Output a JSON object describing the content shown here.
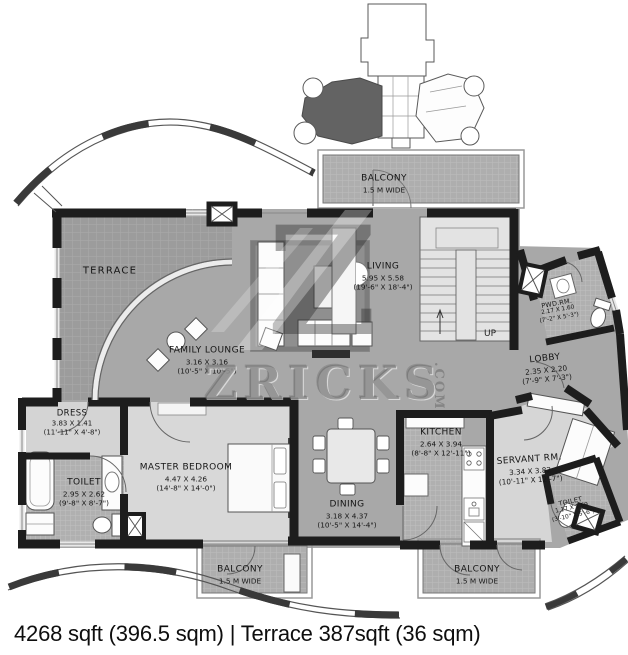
{
  "footer": {
    "caption": "4268 sqft (396.5 sqm) | Terrace 387sqft (36 sqm)"
  },
  "watermark": {
    "logo": "Z",
    "brand": "ZRICKS",
    "tld": ".COM"
  },
  "stairs": {
    "up": "UP"
  },
  "rooms": {
    "terrace": {
      "name": "TERRACE"
    },
    "balcony_top": {
      "name": "BALCONY",
      "dim_m": "1.5 M WIDE"
    },
    "living": {
      "name": "LIVING",
      "dim_m": "5.95 X 5.58",
      "dim_ft": "(19'-6\" X 18'-4\")"
    },
    "family_lounge": {
      "name": "FAMILY LOUNGE",
      "dim_m": "3.16 X 3.16",
      "dim_ft": "(10'-5\" X 10'-5\")"
    },
    "pwd_rm": {
      "name": "PWD.RM.",
      "dim_m": "2.17 X 1.60",
      "dim_ft": "(7'-2\" X 5'-3\")"
    },
    "lobby": {
      "name": "LOBBY",
      "dim_m": "2.35 X 2.20",
      "dim_ft": "(7'-9\" X 7'-3\")"
    },
    "dress": {
      "name": "DRESS",
      "dim_m": "3.83 X 1.41",
      "dim_ft": "(11'-11\" X 4'-8\")"
    },
    "toilet_master": {
      "name": "TOILET",
      "dim_m": "2.95 X 2.62",
      "dim_ft": "(9'-8\" X 8'-7\")"
    },
    "master_bedroom": {
      "name": "MASTER BEDROOM",
      "dim_m": "4.47 X 4.26",
      "dim_ft": "(14'-8\" X 14'-0\")"
    },
    "dining": {
      "name": "DINING",
      "dim_m": "3.18 X 4.37",
      "dim_ft": "(10'-5\" X 14'-4\")"
    },
    "kitchen": {
      "name": "KITCHEN",
      "dim_m": "2.64 X 3.94",
      "dim_ft": "(8'-8\" X 12'-11\")"
    },
    "servant_rm": {
      "name": "SERVANT RM.",
      "dim_m": "3.34 X 3.82",
      "dim_ft": "(10'-11\" X 12'-7\")"
    },
    "toilet_servant": {
      "name": "TOILET",
      "dim_m": "1.17 X 1.69",
      "dim_ft": "(3'-10\" X 5'-6\")"
    },
    "balcony_bl": {
      "name": "BALCONY",
      "dim_m": "1.5 M WIDE"
    },
    "balcony_br": {
      "name": "BALCONY",
      "dim_m": "1.5 M WIDE"
    }
  },
  "colors": {
    "wall": "#1d1d1d",
    "floor": "#a8a8a8",
    "terrace": "#9c9c9c",
    "light_room": "#d8d8d8",
    "stairs": "#e3e3e3",
    "highlight_unit": "#636363"
  }
}
